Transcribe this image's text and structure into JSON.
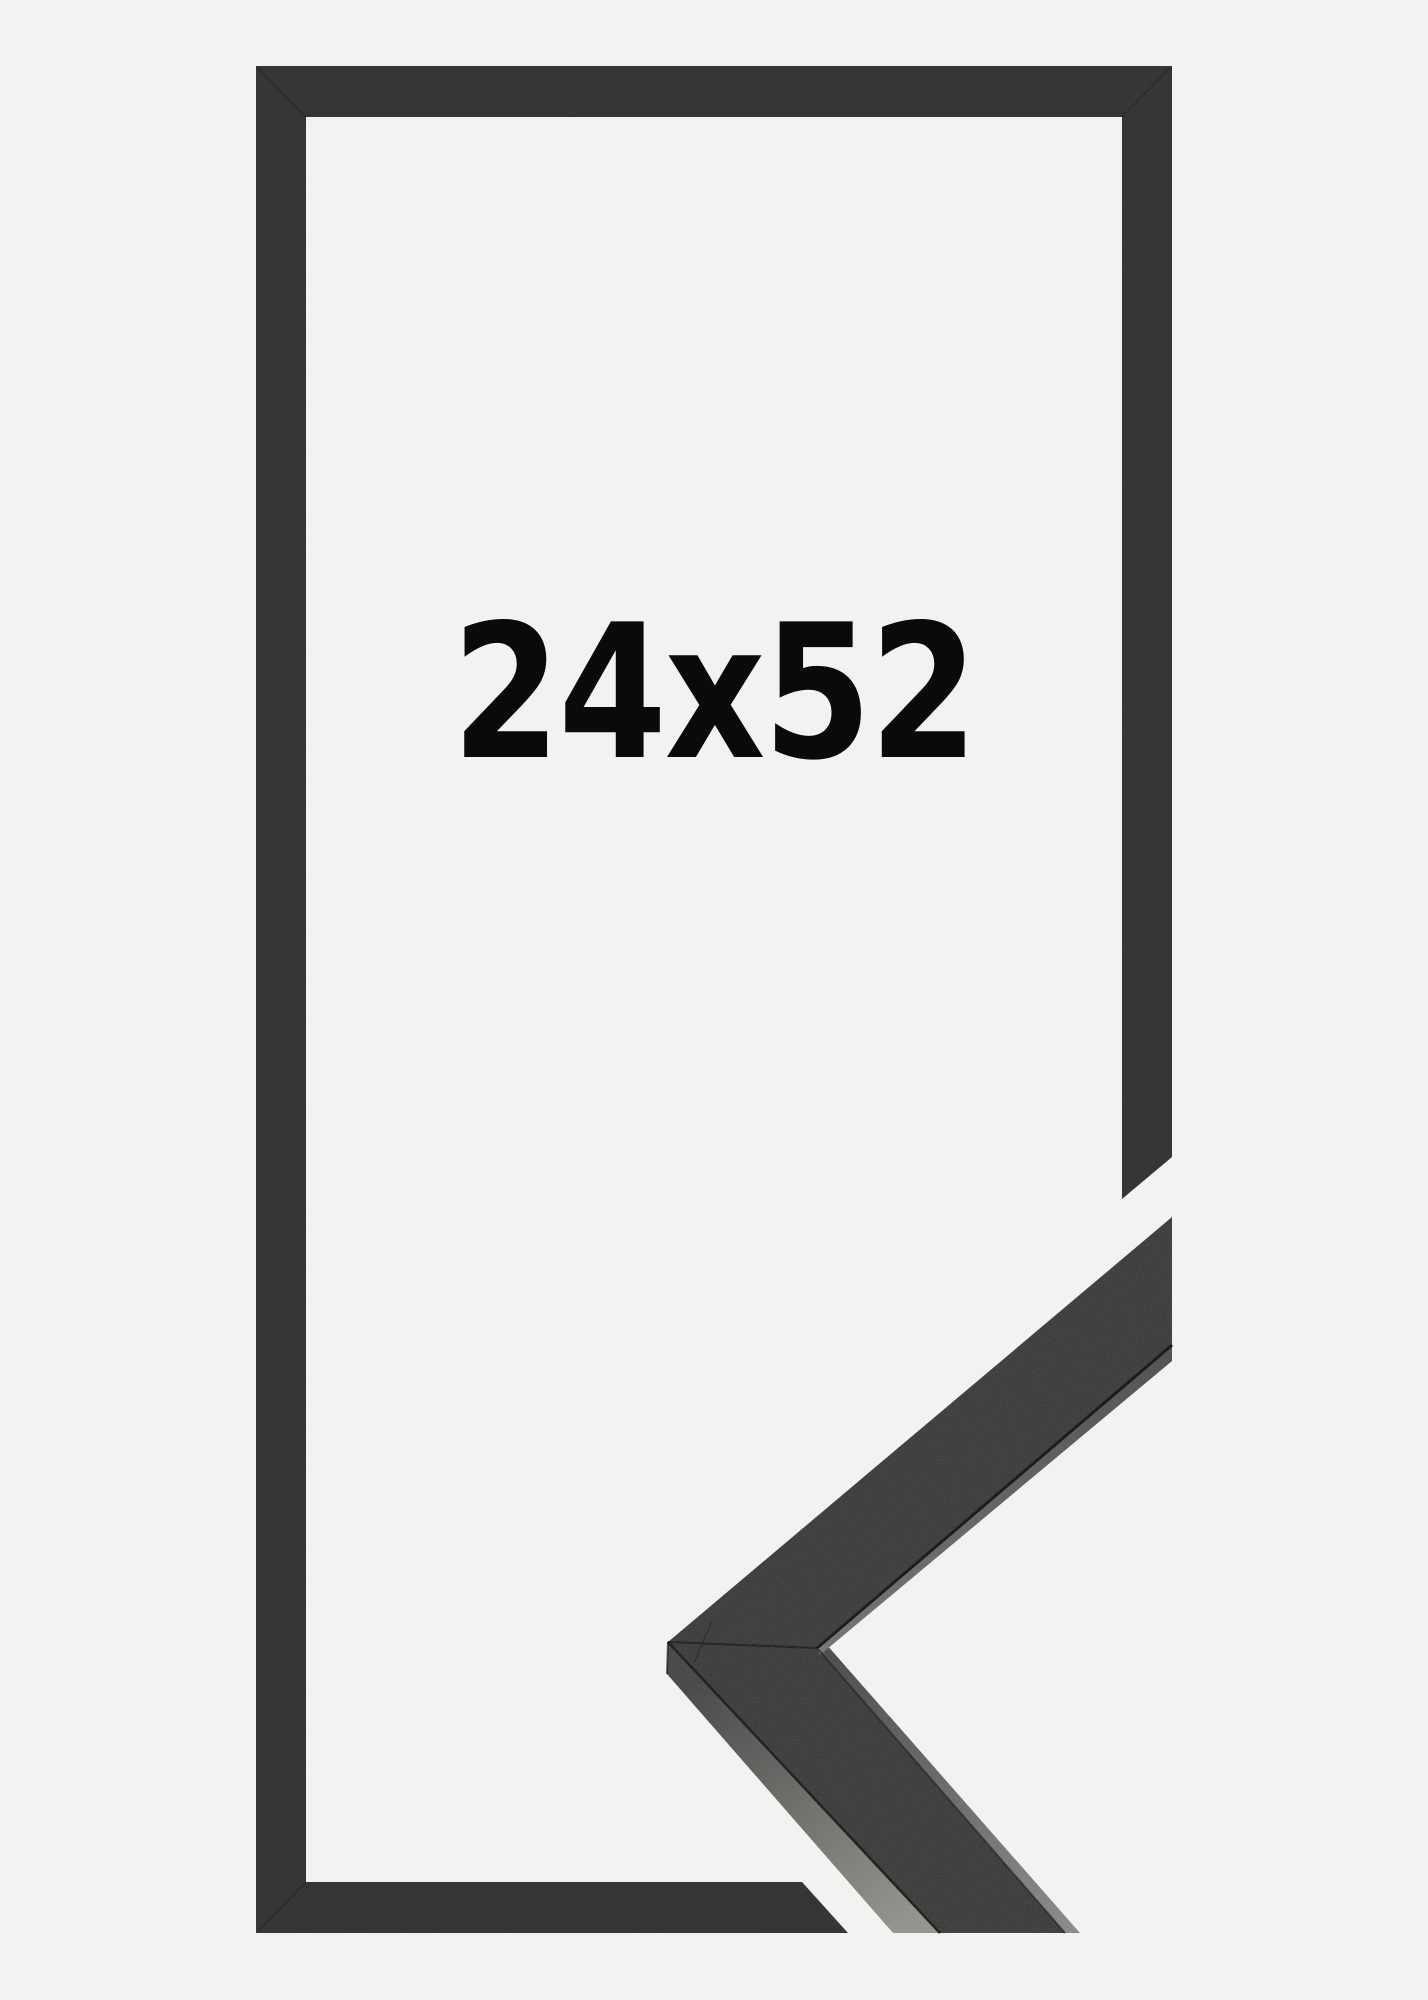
{
  "frame_illustration": {
    "size_label": "24x52"
  },
  "colors": {
    "background": "#f2f2f0",
    "frame_bar": "#333332",
    "label_text": "#0a0a0a",
    "molding_front": "#3a3a38",
    "molding_side_dark": "#454543",
    "molding_side_light": "#92928f",
    "molding_stripe_dark": "#4a4a48",
    "molding_stripe_light": "#8a8a88",
    "molding_highlight_left": "#757573",
    "molding_highlight_right": "#545452",
    "molding_seam": "#1a1a18"
  }
}
